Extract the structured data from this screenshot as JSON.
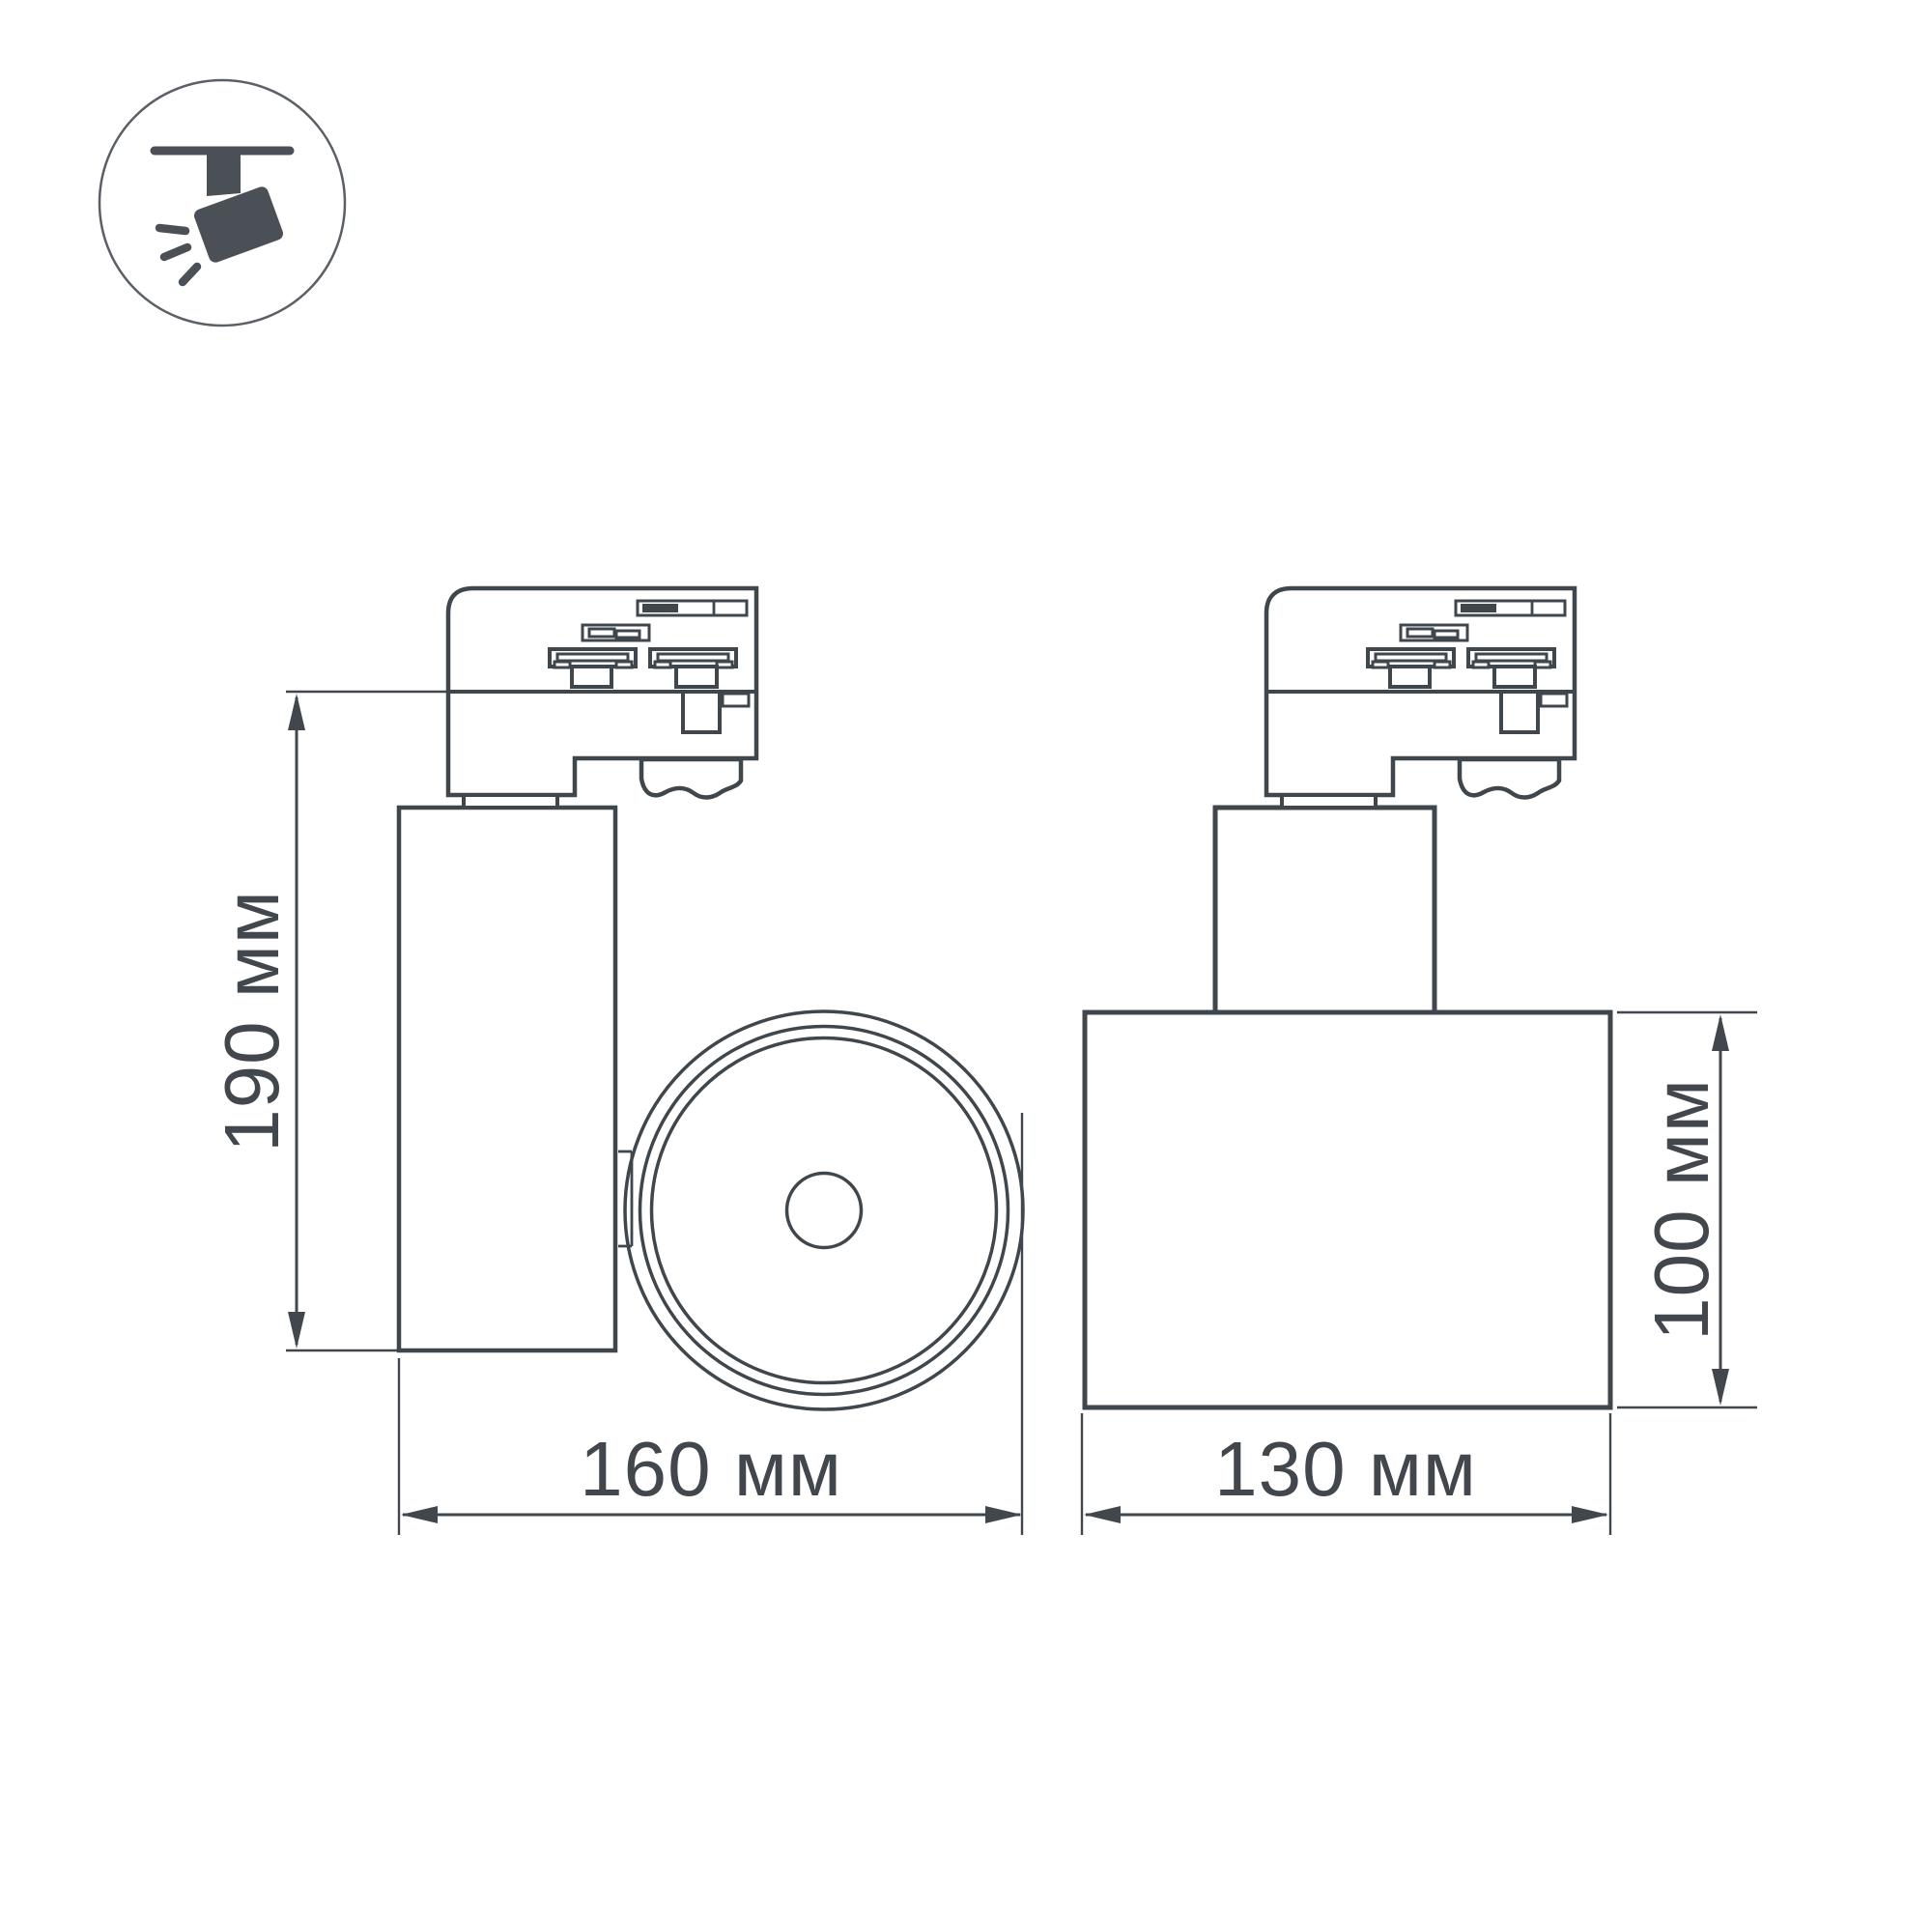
{
  "icon": {
    "name": "track-spotlight-icon",
    "symbol_color": "#4a5056",
    "ring_color": "#5a6066"
  },
  "drawing": {
    "background": "#ffffff",
    "line_color": "#3f464c",
    "dimension_color": "#41474d",
    "views": [
      "side-view-with-lens-front",
      "rear-view"
    ]
  },
  "dimensions": {
    "height": "190 мм",
    "width": "160 мм",
    "depth": "130 мм",
    "body_height": "100 мм"
  }
}
